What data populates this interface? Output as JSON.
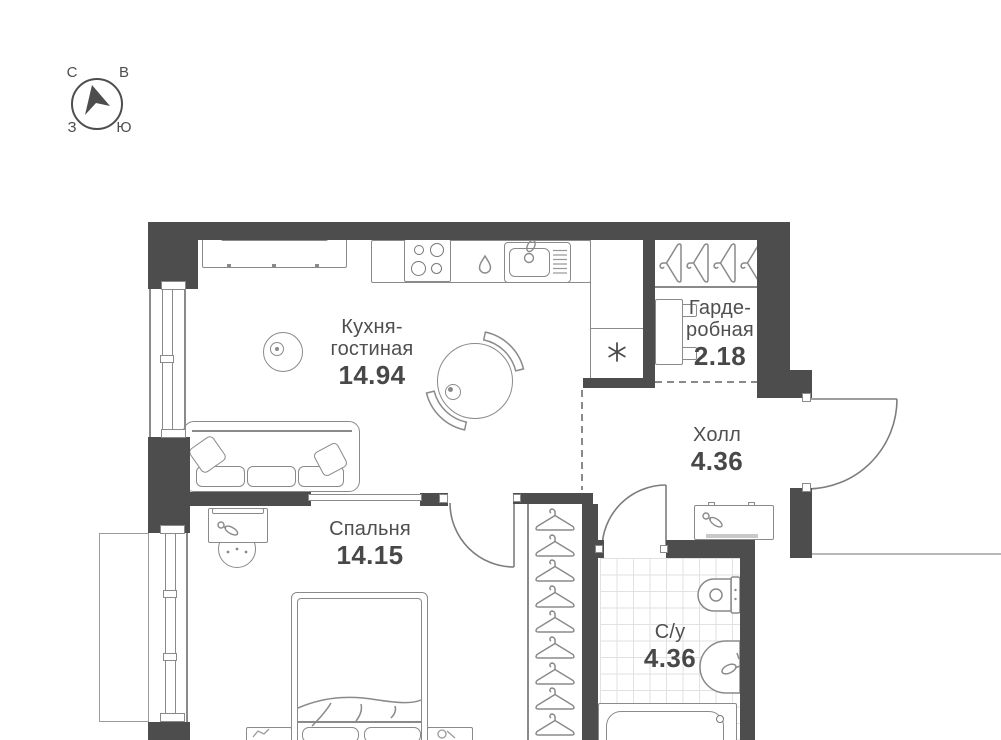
{
  "compass": {
    "north": "С",
    "east": "В",
    "west": "З",
    "south": "Ю"
  },
  "rooms": [
    {
      "id": "kitchen-living",
      "label_lines": [
        "Кухня-",
        "гостиная"
      ],
      "area": "14.94"
    },
    {
      "id": "wardrobe",
      "label_lines": [
        "Гарде-",
        "робная"
      ],
      "area": "2.18"
    },
    {
      "id": "hall",
      "label_lines": [
        "Холл"
      ],
      "area": "4.36"
    },
    {
      "id": "bedroom",
      "label_lines": [
        "Спальня"
      ],
      "area": "14.15"
    },
    {
      "id": "bathroom",
      "label_lines": [
        "С/у"
      ],
      "area": "4.36"
    }
  ],
  "icons": {
    "compass-arrow": "north-pointer triangle",
    "hanger-icon": "coat hanger",
    "stove-icon": "4-burner cooktop",
    "sink-icon": "kitchen sink with drainer",
    "droplet-icon": "water drop",
    "fridge-niche-icon": "✳",
    "keys-icon": "keys",
    "toilet-icon": "toilet",
    "washbasin-icon": "washbasin",
    "bathtub-icon": "bathtub"
  },
  "colors": {
    "wall": "#4d4d4d",
    "furniture_line": "#8a8a8a",
    "text": "#4f4f4f",
    "tile_line": "#e2e2e2"
  }
}
